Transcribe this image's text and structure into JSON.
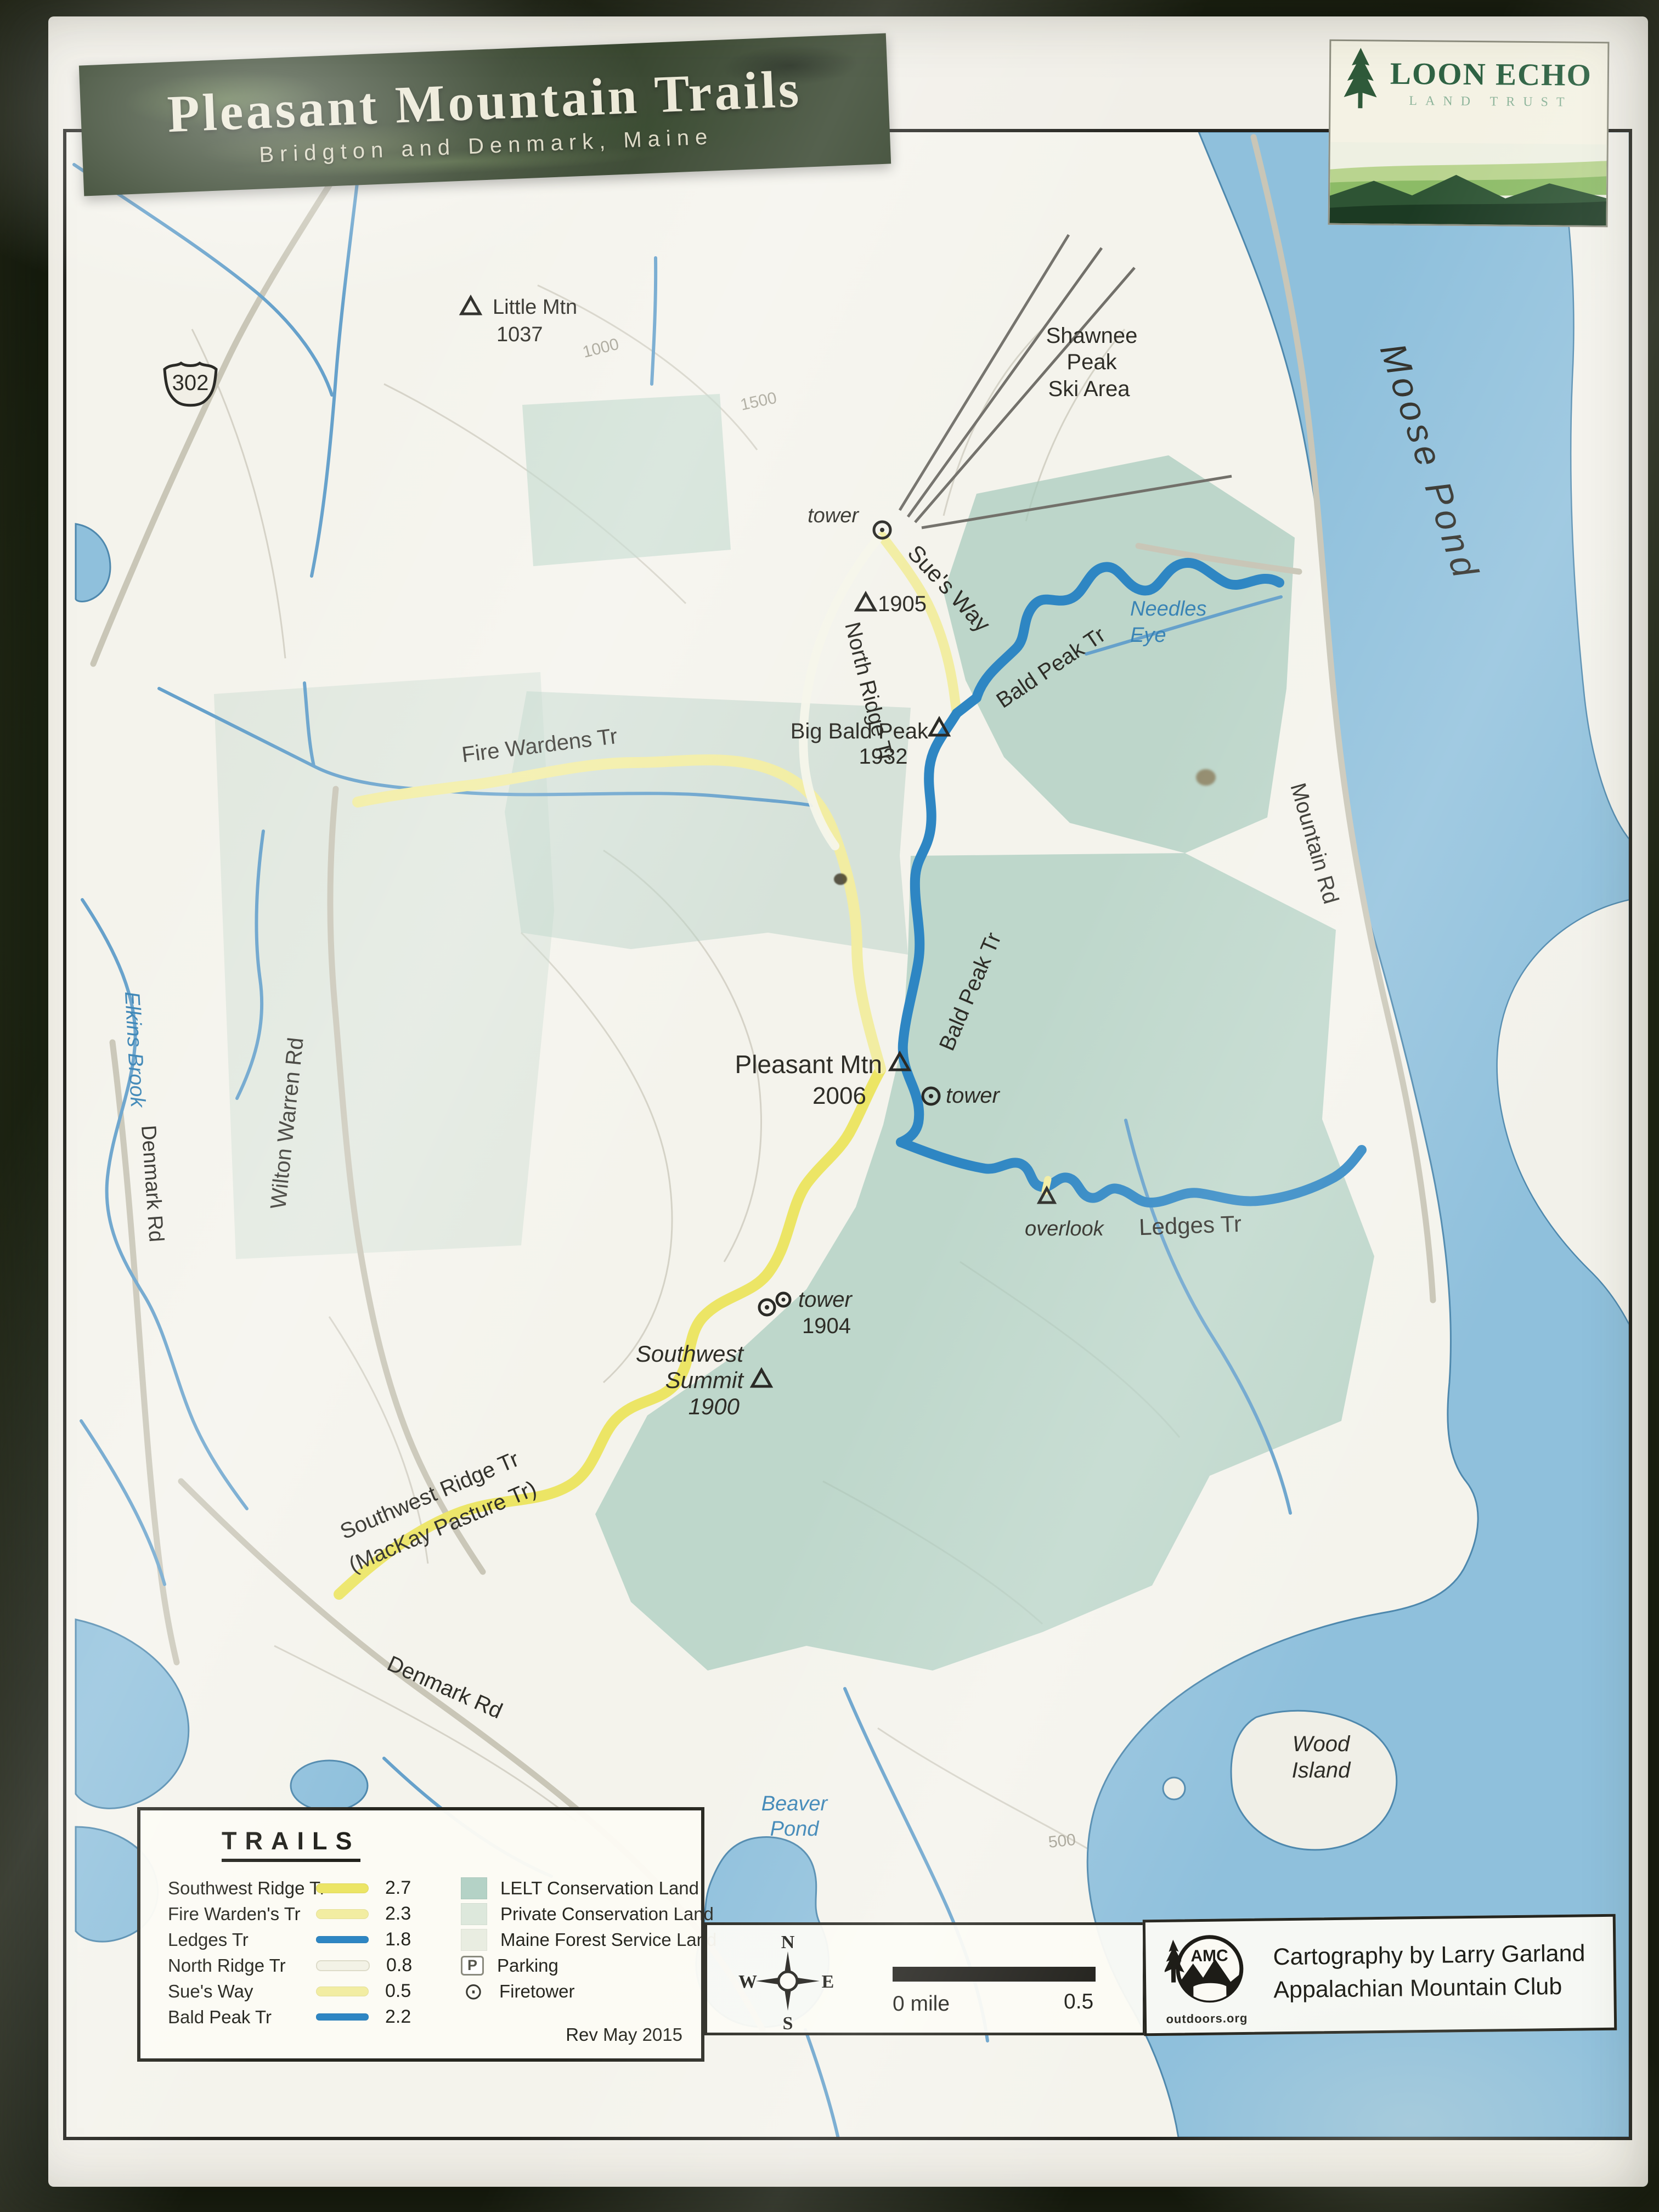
{
  "photo": {
    "board_color": "#1a2313",
    "paper_color": "#f1efe8"
  },
  "banner": {
    "title": "Pleasant Mountain Trails",
    "subtitle": "Bridgton and Denmark, Maine",
    "bg_color": "#2b3a22",
    "text_color": "#eae7d3"
  },
  "publisher": {
    "name": "LOON ECHO",
    "tagline": "LAND TRUST",
    "text_color": "#2f6344"
  },
  "map": {
    "water_color": "#8fc0dc",
    "conservation_color": "#a7cabd",
    "trail_yellow": "#ece565",
    "trail_pale_yellow": "#f2eda2",
    "trail_blue": "#2e86c3",
    "labels": {
      "little_mtn": "Little Mtn",
      "little_mtn_elev": "1037",
      "shawnee_1": "Shawnee",
      "shawnee_2": "Peak",
      "shawnee_3": "Ski Area",
      "moose_pond": "Moose Pond",
      "north_tower": "tower",
      "sues_way": "Sue's Way",
      "peak_1905": "1905",
      "north_ridge": "North Ridge Tr",
      "bald_peak_upper": "Bald Peak Tr",
      "needles_1": "Needles",
      "needles_2": "Eye",
      "big_bald": "Big Bald Peak",
      "big_bald_elev": "1932",
      "fire_wardens": "Fire Wardens Tr",
      "mountain_rd": "Mountain Rd",
      "wilton_warren_rd": "Wilton Warren Rd",
      "elkins_brook": "Elkins Brook",
      "denmark_rd_left": "Denmark Rd",
      "pleasant_mtn": "Pleasant Mtn",
      "pleasant_elev": "2006",
      "pleasant_tower": "tower",
      "bald_peak_lower": "Bald Peak Tr",
      "ledges_tr": "Ledges Tr",
      "overlook": "overlook",
      "tower_1904": "tower",
      "tower_1904_elev": "1904",
      "sw_summit_1": "Southwest",
      "sw_summit_2": "Summit",
      "sw_summit_elev": "1900",
      "sw_ridge_1": "Southwest Ridge Tr",
      "sw_ridge_2": "(MacKay Pasture Tr)",
      "denmark_rd_bottom": "Denmark Rd",
      "beaver_1": "Beaver",
      "beaver_2": "Pond",
      "wood_1": "Wood",
      "wood_2": "Island",
      "route_shield": "302",
      "contour_1000": "1000",
      "contour_1500": "1500",
      "contour_500": "500"
    }
  },
  "legend": {
    "title": "TRAILS",
    "rows": [
      {
        "name": "Southwest Ridge Tr",
        "miles": "2.7",
        "color": "#ece565"
      },
      {
        "name": "Fire Warden's Tr",
        "miles": "2.3",
        "color": "#f2eda2"
      },
      {
        "name": "Ledges Tr",
        "miles": "1.8",
        "color": "#2e86c3"
      },
      {
        "name": "North Ridge Tr",
        "miles": "0.8",
        "color": "#f3f2e6"
      },
      {
        "name": "Sue's Way",
        "miles": "0.5",
        "color": "#f2eda2"
      },
      {
        "name": "Bald Peak Tr",
        "miles": "2.2",
        "color": "#2e86c3"
      }
    ],
    "land_rows": [
      {
        "name": "LELT Conservation Land",
        "color": "#b4d2c6"
      },
      {
        "name": "Private Conservation Land",
        "color": "#dde8dc"
      },
      {
        "name": "Maine Forest Service Land",
        "color": "#e9ede1"
      },
      {
        "name": "Parking",
        "icon": "P"
      },
      {
        "name": "Firetower",
        "icon": "⊙"
      }
    ],
    "revision": "Rev May 2015"
  },
  "scale_bar": {
    "compass": {
      "n": "N",
      "w": "W",
      "e": "E",
      "s": "S"
    },
    "start_label": "0 mile",
    "end_label": "0.5"
  },
  "credit": {
    "logo_abbr": "AMC",
    "logo_site": "outdoors.org",
    "line1": "Cartography by Larry Garland",
    "line2": "Appalachian Mountain Club"
  }
}
